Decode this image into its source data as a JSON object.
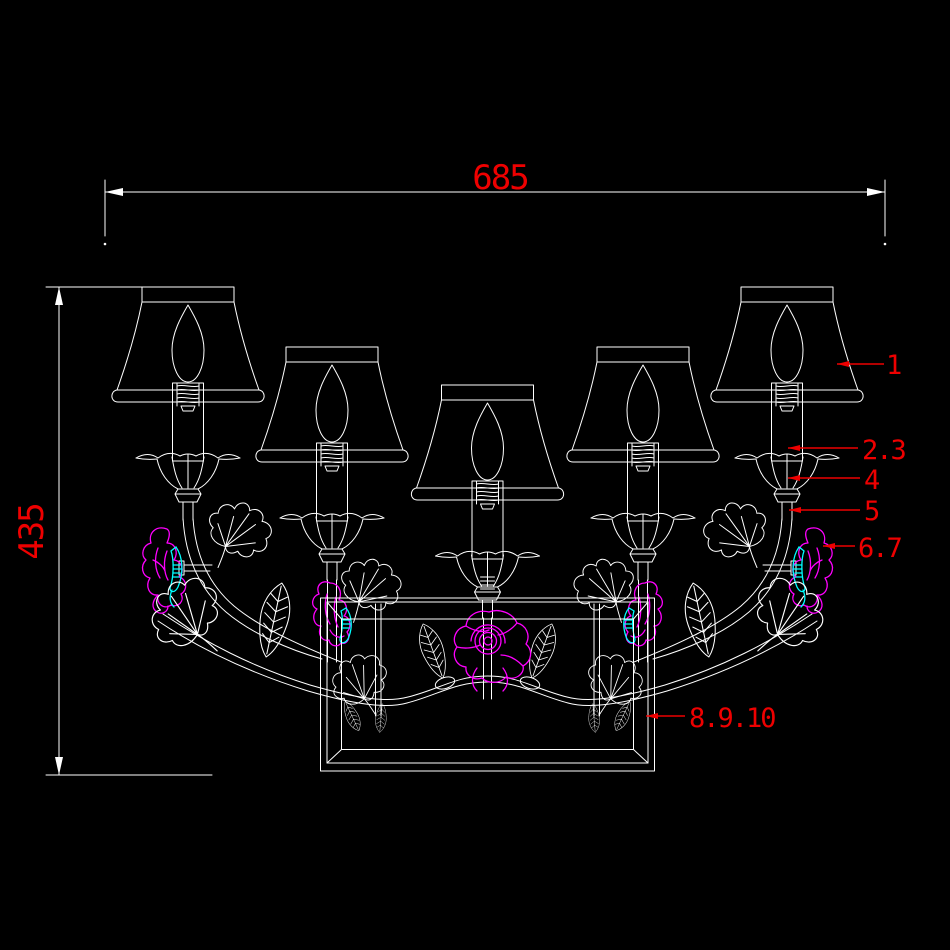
{
  "drawing": {
    "title": "CAD line drawing - five-light floral wall lamp, front elevation",
    "colors": {
      "bg": "#000000",
      "line": "#ffffff",
      "dim": "#ee0000",
      "flower": "#ff00ff",
      "accent": "#00ffff"
    },
    "dimensions": {
      "width": {
        "value": "685"
      },
      "height": {
        "value": "435"
      }
    },
    "part_labels": [
      {
        "part": "lamp-shade",
        "text": "1"
      },
      {
        "part": "candle-tube",
        "text": "2.3"
      },
      {
        "part": "bobeche-flower-cup",
        "text": "4"
      },
      {
        "part": "arm-stem",
        "text": "5"
      },
      {
        "part": "porcelain-flower",
        "text": "6.7"
      },
      {
        "part": "back-frame",
        "text": "8.9.10"
      }
    ]
  }
}
